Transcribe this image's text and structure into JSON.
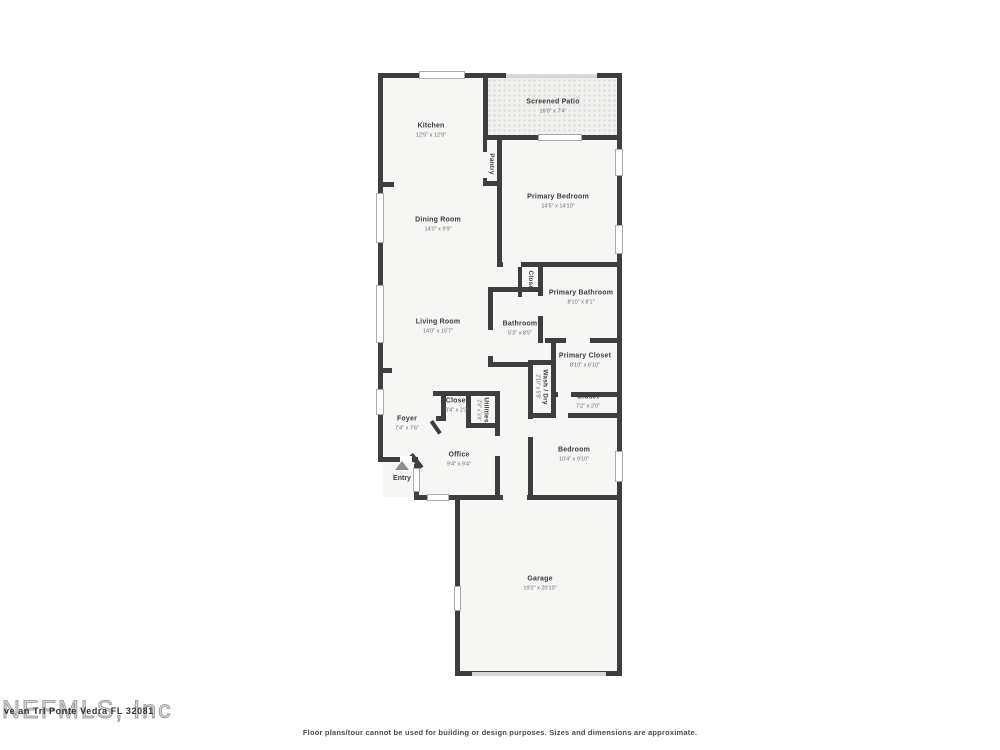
{
  "palette": {
    "wall_color": "#3e3e3e",
    "room_fill": "#f6f6f4",
    "patio_fill": "#f1f1ef",
    "background": "#ffffff"
  },
  "rooms": [
    {
      "name": "Kitchen",
      "dims": "12'5\" x 12'9\""
    },
    {
      "name": "Screened Patio",
      "dims": "16'0\" x 7'4\""
    },
    {
      "name": "Pantry",
      "dims": ""
    },
    {
      "name": "Primary Bedroom",
      "dims": "14'5\" x 14'10\""
    },
    {
      "name": "Dining Room",
      "dims": "14'0\" x 9'9\""
    },
    {
      "name": "Closet",
      "dims": ""
    },
    {
      "name": "Primary Bathroom",
      "dims": "8'10\" x 8'1\""
    },
    {
      "name": "Living Room",
      "dims": "14'0\" x 15'7\""
    },
    {
      "name": "Bathroom",
      "dims": "5'3\" x 8'5\""
    },
    {
      "name": "Primary Closet",
      "dims": "8'10\" x 6'10\""
    },
    {
      "name": "Wash / Dry",
      "dims": "2'10\" x 5'9\""
    },
    {
      "name": "Closet",
      "dims": "7'2\" x 2'0\""
    },
    {
      "name": "Closet",
      "dims": "3'4\" x 2'3\""
    },
    {
      "name": "Utilities",
      "dims": "2'9\" x 3'4\""
    },
    {
      "name": "Foyer",
      "dims": "7'4\" x 7'6\""
    },
    {
      "name": "Office",
      "dims": "9'4\" x 9'4\""
    },
    {
      "name": "Bedroom",
      "dims": "10'4\" x 9'10\""
    },
    {
      "name": "Garage",
      "dims": "19'2\" x 20'10\""
    }
  ],
  "entry": {
    "label": "Entry"
  },
  "watermark": {
    "mls": "NEFMLS, Inc",
    "address": "ve an Trl Ponte Vedra FL 32081"
  },
  "footer": {
    "disclaimer": "Floor plans/tour cannot be used for building or design purposes. Sizes and dimensions are approximate."
  }
}
